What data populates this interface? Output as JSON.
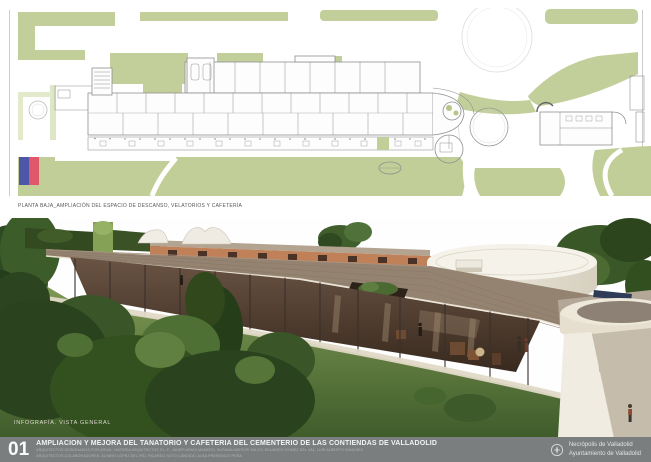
{
  "sheet": {
    "plan": {
      "caption": "PLANTA BAJA_AMPLIACIÓN DEL ESPACIO DE DESCANSO, VELATORIOS Y CAFETERÍA"
    },
    "render": {
      "label": "INFOGRAFÍA. VISTA GENERAL"
    },
    "footer": {
      "sheet_number": "01",
      "title": "AMPLIACIÓN Y MEJORA DEL TANATORIO Y CAFETERÍA DEL CEMENTERIO DE LAS CONTIENDAS DE VALLADOLID",
      "credits_line1": "ARQUITECTOS DESIGNADOS POR ARVAL: MATERIA ARQUITECTOS S.L.P., JAVIER ARIAS MADERO, SUSANA MATEOS SALVO, EDUARDO GÓMEZ DEL VAL, LUIS ALBERTO SÁNCHEZ",
      "credits_line2": "ARQUITECTOS COLABORADORES: ÁLVARO LÓPEZ DEL RÍO, RICARDO SOTO CÁNDIDO, ALBA PRESENCIO PEÑA",
      "org_line1": "Necrópolis de Valladolid",
      "org_line2": "Ayuntamiento de Valladolid"
    },
    "colors": {
      "plan_green": "#c3cf9a",
      "legend_blue": "#4e57a7",
      "legend_red": "#e0566a",
      "footer_gray": "#7a7e7f",
      "roof_taupe": "#958371",
      "wall_terracotta": "#c08058"
    }
  }
}
